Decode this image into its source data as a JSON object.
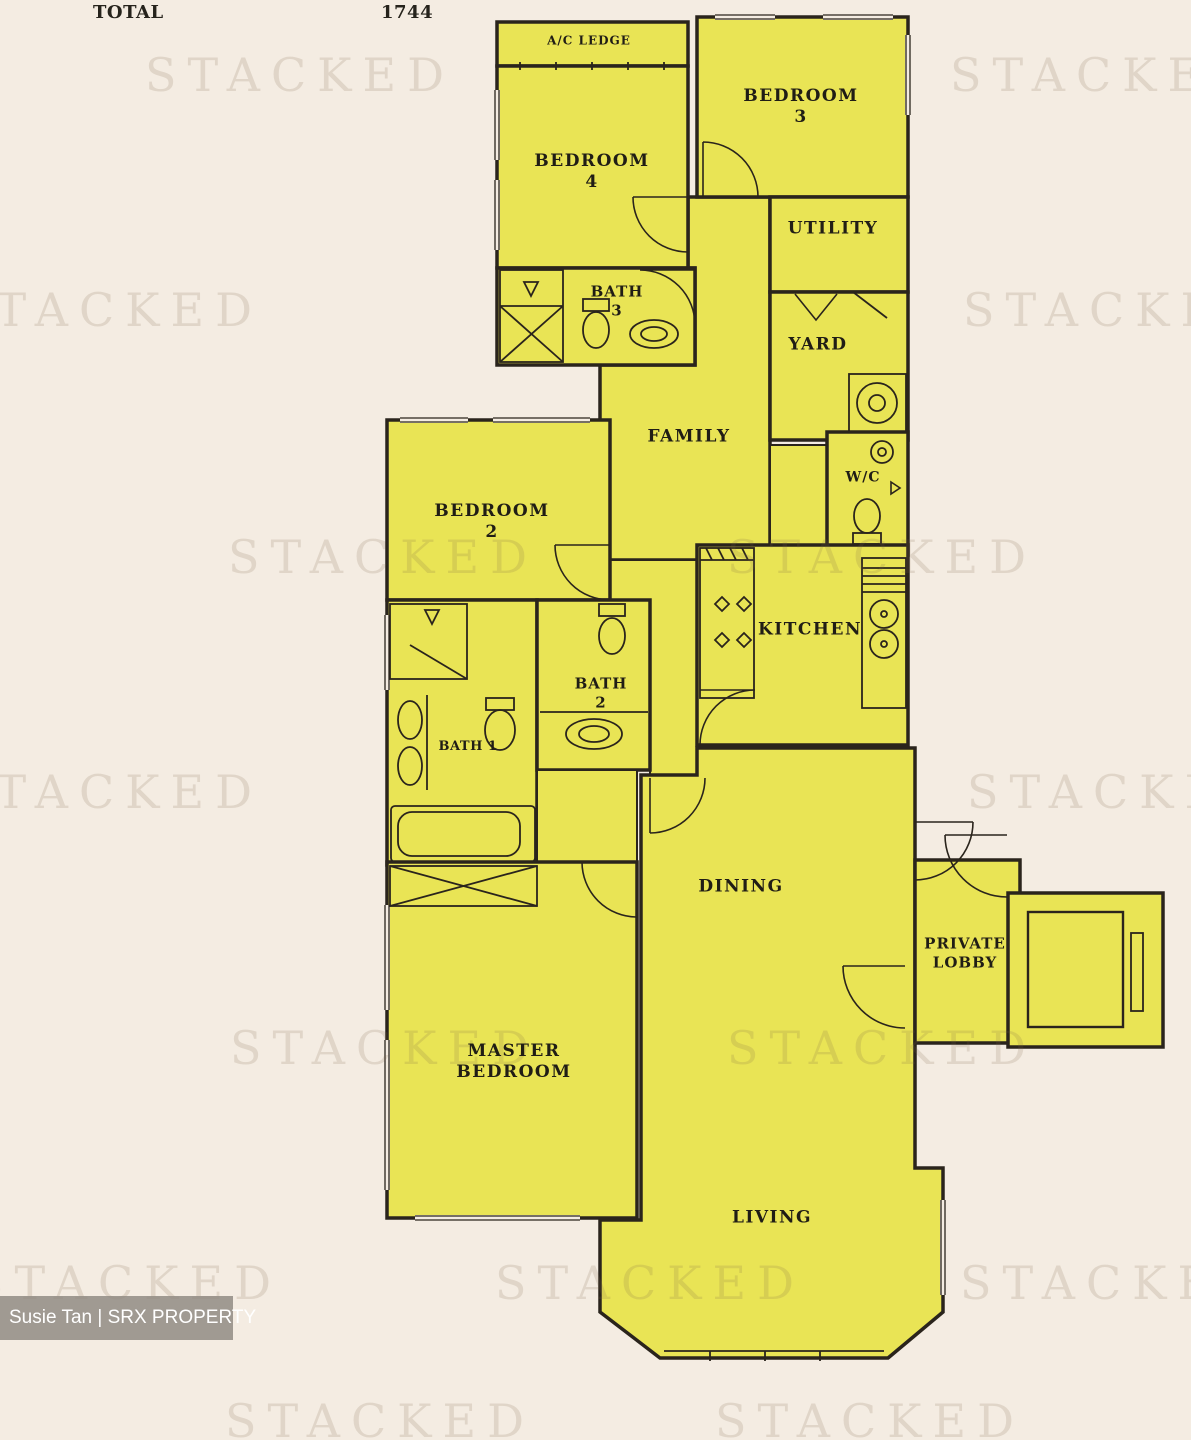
{
  "header": {
    "total_label": "TOTAL",
    "total_value": "1744"
  },
  "watermark": {
    "text": "STACKED"
  },
  "credit": {
    "agent": "Susie Tan | SRX PROPERTY"
  },
  "rooms": {
    "ac_ledge": {
      "label": "A/C LEDGE"
    },
    "bedroom3": {
      "label": "BEDROOM",
      "number": "3"
    },
    "bedroom4": {
      "label": "BEDROOM",
      "number": "4"
    },
    "bath3": {
      "label": "BATH",
      "number": "3"
    },
    "utility": {
      "label": "UTILITY"
    },
    "yard": {
      "label": "YARD"
    },
    "family": {
      "label": "FAMILY"
    },
    "wc": {
      "label": "W/C"
    },
    "kitchen": {
      "label": "KITCHEN"
    },
    "bedroom2": {
      "label": "BEDROOM",
      "number": "2"
    },
    "bath2": {
      "label": "BATH",
      "number": "2"
    },
    "bath1": {
      "label": "BATH 1"
    },
    "dining": {
      "label": "DINING"
    },
    "private_lobby": {
      "label": "PRIVATE",
      "label2": "LOBBY"
    },
    "master_bedroom": {
      "label": "MASTER",
      "label2": "BEDROOM"
    },
    "living": {
      "label": "LIVING"
    }
  },
  "colors": {
    "background": "#f4ece2",
    "room_fill": "#e9e455",
    "wall": "#2a241c",
    "watermark": "#7c6648",
    "credit_bg": "#8d8880",
    "credit_text": "#ffffff"
  }
}
